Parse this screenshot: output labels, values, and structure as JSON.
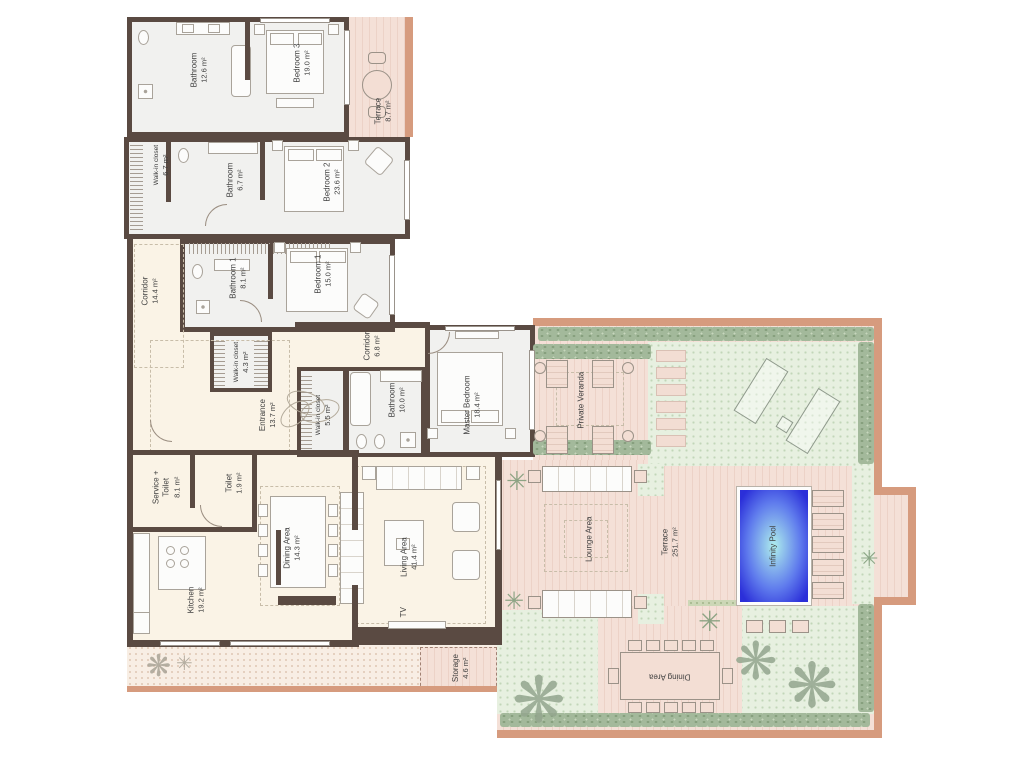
{
  "rooms": {
    "bathroom3": {
      "label": "Bathroom",
      "area": "12.6 m²"
    },
    "bedroom3": {
      "label": "Bedroom 3",
      "area": "19.0 m²"
    },
    "terrace_top": {
      "label": "Terrace",
      "area": "8.7 m²"
    },
    "wic_top": {
      "label": "Walk-in closet",
      "area": "6.7 m²"
    },
    "bathroom2": {
      "label": "Bathroom",
      "area": "6.7 m²"
    },
    "bedroom2": {
      "label": "Bedroom 2",
      "area": "23.6 m²"
    },
    "corridor_main": {
      "label": "Corridor",
      "area": "14.4 m²"
    },
    "bathroom1": {
      "label": "Bathroom 1",
      "area": "8.1 m²"
    },
    "bedroom1": {
      "label": "Bedroom 1",
      "area": "15.0 m²"
    },
    "wic_mid": {
      "label": "Walk-in closet",
      "area": "4.3 m²"
    },
    "corridor_master": {
      "label": "Corridor",
      "area": "6.8 m²"
    },
    "wic_master": {
      "label": "Walk-in closet",
      "area": "5.5 m²"
    },
    "bathroom_master": {
      "label": "Bathroom",
      "area": "10.0 m²"
    },
    "master_bedroom": {
      "label": "Master Bedroom",
      "area": "18.4 m²"
    },
    "entrance": {
      "label": "Entrance",
      "area": "13.7 m²"
    },
    "service_toilet": {
      "label": "Service + Toilet",
      "area": "8.1 m²"
    },
    "toilet": {
      "label": "Toilet",
      "area": "1.9 m²"
    },
    "kitchen": {
      "label": "Kitchen",
      "area": "19.2 m²"
    },
    "dining": {
      "label": "Dining Area",
      "area": "14.3 m²"
    },
    "living": {
      "label": "Living Area",
      "area": "41.4 m²"
    },
    "tv": {
      "label": "TV"
    },
    "storage": {
      "label": "Storage",
      "area": "4.6 m²"
    },
    "private_veranda": {
      "label": "Private Veranda"
    },
    "lounge": {
      "label": "Lounge Area"
    },
    "terrace_main": {
      "label": "Terrace",
      "area": "251.7 m²"
    },
    "pool": {
      "label": "Infinity Pool"
    },
    "outdoor_dining": {
      "label": "Dining Area"
    }
  },
  "colors": {
    "wall": "#5a4a42",
    "bedroom_floor": "#f1f1ef",
    "living_floor": "#faf3e6",
    "deck": "#f4e0d7",
    "outdoor_border": "#d69b7e",
    "garden": "#e7f0e0",
    "hedge": "#a3b99b",
    "pool_edge": "#2b2fd9",
    "pool_center": "#aeeeec",
    "text": "#3f3f3f"
  }
}
